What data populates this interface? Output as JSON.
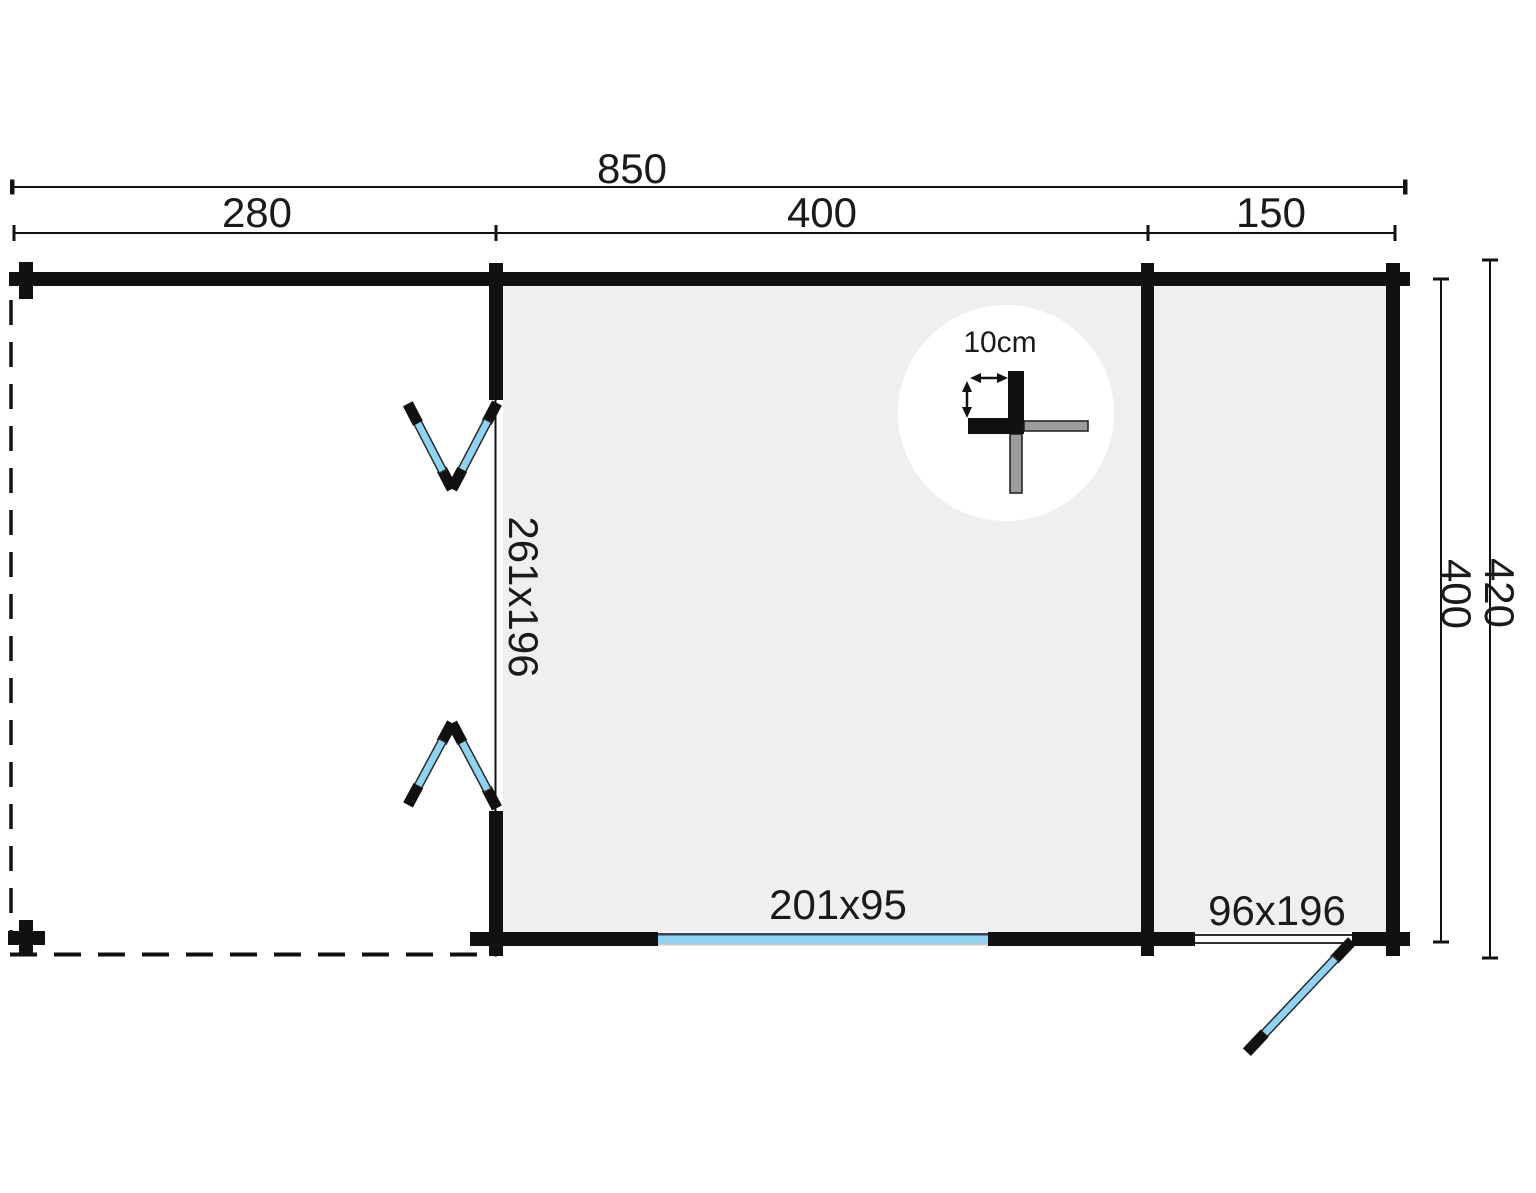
{
  "plan": {
    "dims": {
      "total_width": "850",
      "terrace_width": "280",
      "main_room_width": "400",
      "annex_width": "150",
      "inner_depth": "400",
      "outer_depth": "420"
    },
    "labels": {
      "double_door": "261x196",
      "window": "201x95",
      "annex_door": "96x196",
      "wall_thickness": "10cm"
    }
  },
  "colors": {
    "wall": "#111111",
    "room": "#efeff1",
    "glass": "#8ed3f2",
    "glass_top": "#3a4252",
    "glass_sill": "#c9c9c9",
    "gray_bar": "#9c9c9c"
  }
}
